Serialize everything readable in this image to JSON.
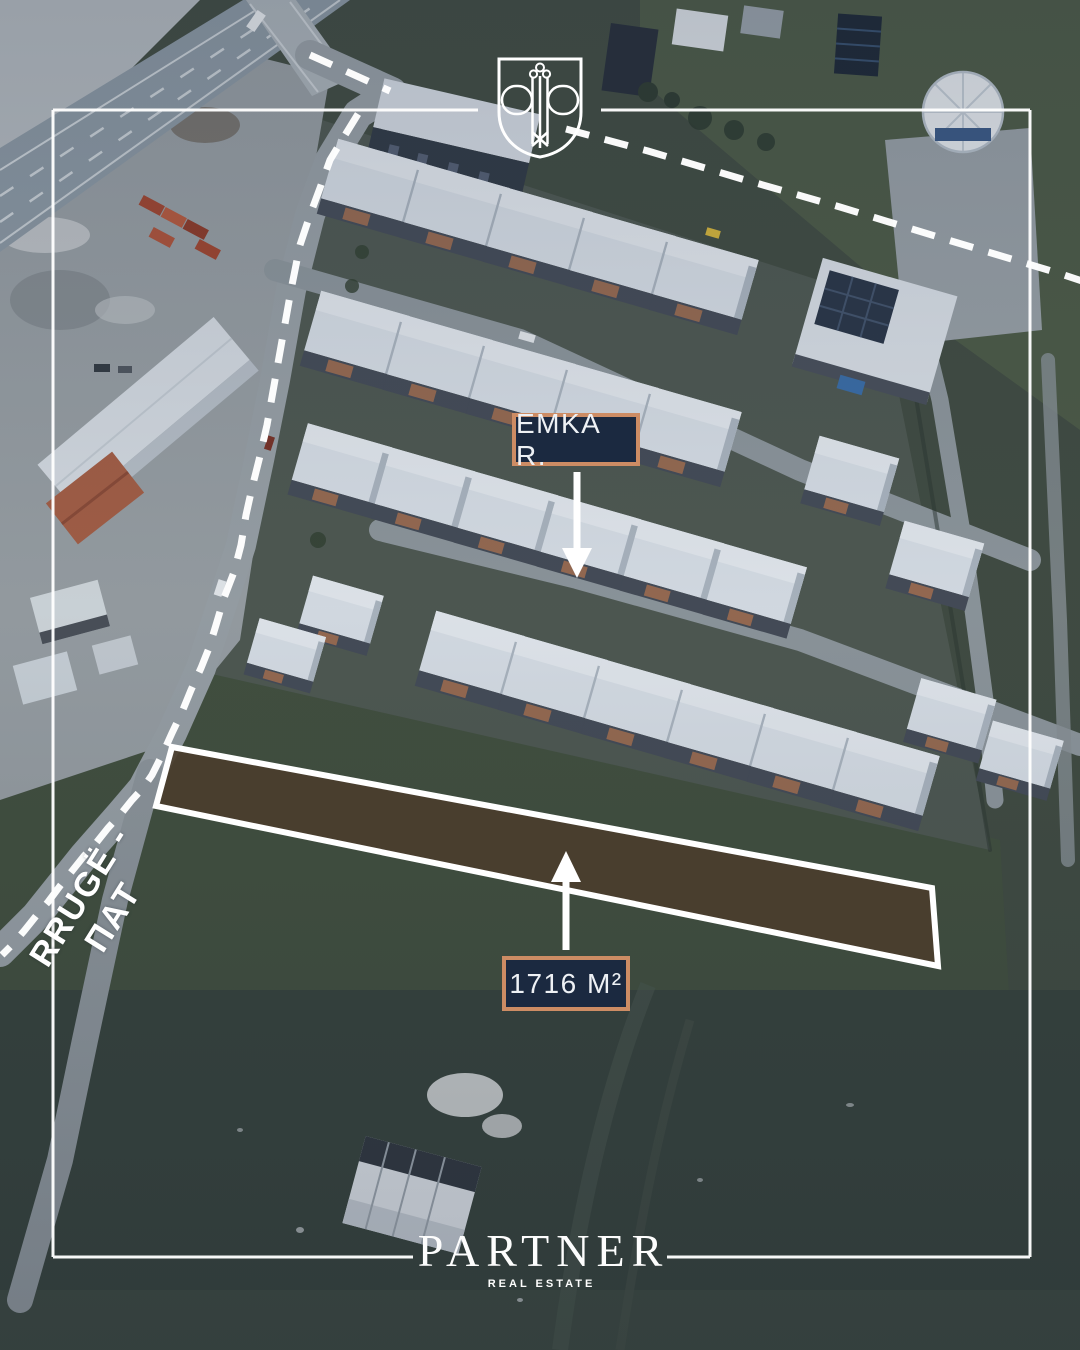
{
  "annotations": {
    "street_label": "EMKA R.",
    "area_label": "1716 M²",
    "road_label": "RRUGË - ПАТ"
  },
  "brand": {
    "name": "PARTNER",
    "tagline": "REAL ESTATE"
  },
  "icons": {
    "crest": "shield-with-double-p-monogram-and-key"
  },
  "colors": {
    "label_background": "#1b2940",
    "label_border": "#cd8c64",
    "frame_white": "#ffffff",
    "parcel_fill": "#4a3d2c",
    "annotation_white": "#ffffff"
  }
}
